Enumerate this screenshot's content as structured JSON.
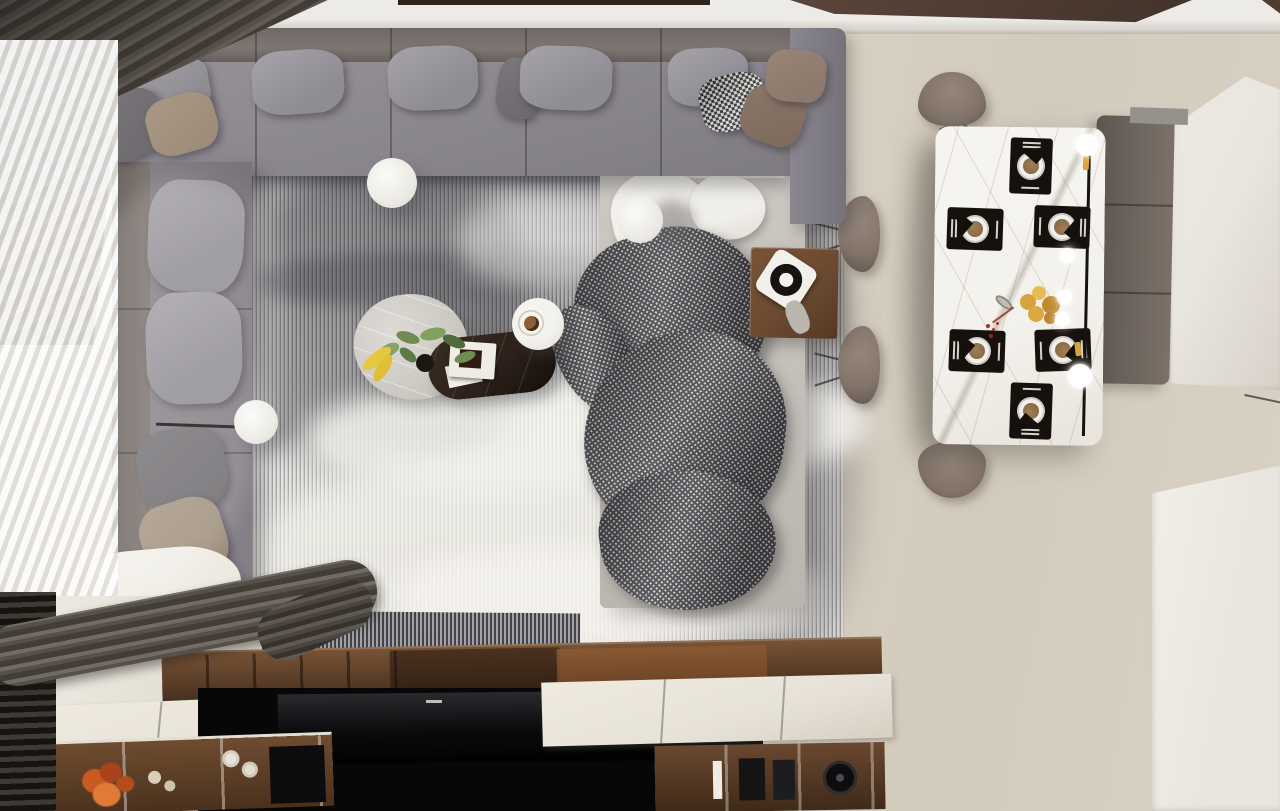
{
  "scene": {
    "title": "top-down-render-living-dining-room",
    "view": "bird's-eye interior render",
    "zones": [
      "window-side",
      "living-area",
      "dining-area",
      "media-wall"
    ]
  },
  "palette": {
    "floor": "#d8d1c2",
    "plank": "#c3baa9",
    "wall": "#edebe7",
    "ceiling": "#4e3c31",
    "bar": "#30241d",
    "drape": "#423d37",
    "sheer": "#f4f2ef",
    "blind": "#17140f",
    "sofa": "#8d8a91",
    "sofa_back": "#7b7370",
    "pillow_light": "#a6a3a9",
    "pillow_dark": "#6b686c",
    "pillow_taupe": "#9a8a77",
    "hound_dark": "#2f2e31",
    "hound_light": "#d9d8d4",
    "brown_a": "#7d6a5c",
    "brown_b": "#8a766a",
    "rug_light": "#e2e0db",
    "rug_dark": "#77767b",
    "chaise": "#c6c2bc",
    "throw": "#f0eee9",
    "cream": "#e9e5dc",
    "blanket_dark": "#45454a",
    "blanket_light": "#c9c8c3",
    "walnut": "#6b4a31",
    "walnut_dark": "#46301f",
    "marble": "#f3f1ec",
    "vein": "#aaa290",
    "dark_table": "#2c211a",
    "mat": "#17110d",
    "plate": "#f1efe9",
    "plate_in": "#8a6a45",
    "cutlery": "#d6d3cc",
    "bench": "#6e655e",
    "chair": "#83746a",
    "gold": "#d8a33d",
    "berry": "#9c3120",
    "orange": "#c45120",
    "green": "#6f8c52",
    "banana": "#e6c83e",
    "bulb": "#ffffff",
    "tv": "#070708",
    "counter": "#e7e2d8",
    "panel": "#e9e5df"
  },
  "objects": {
    "window": {
      "treatments": [
        "dark-drape",
        "sheer-curtain",
        "gathered-drape-bundle",
        "dark-blind"
      ]
    },
    "sofa": {
      "type": "u-shaped-sectional",
      "pillow_count": 15,
      "accent_pillows": [
        "houndstooth",
        "taupe",
        "dark-gray",
        "brown"
      ]
    },
    "rug": {
      "style": "fine-striped textured, sunlit patches"
    },
    "chaise": {
      "items": [
        "white-throw",
        "checked-knit-blanket"
      ]
    },
    "coffee_tables": [
      {
        "name": "organic-marble-table",
        "items": [
          "potted-plant",
          "bananas"
        ]
      },
      {
        "name": "dark-marble-oval-table",
        "items": [
          "white-tray-book",
          "dessert"
        ]
      },
      {
        "name": "round-mini-table",
        "items": [
          "coffee-cup"
        ]
      }
    ],
    "side_table": {
      "material": "walnut",
      "items": [
        "turntable",
        "gray-cloth"
      ]
    },
    "marble_disc_lamps": 3,
    "dining": {
      "table_material": "white-marble",
      "place_settings": 6,
      "chairs": 4,
      "bench_sections": 3,
      "pendant_bulbs": 5,
      "centerpiece": [
        "gold-flowers",
        "berry-sprig",
        "metal-dish"
      ]
    },
    "media_wall": {
      "tv": true,
      "shelf_items_left": [
        "dried-orange-flowers",
        "seed-spheres",
        "rolled-towels",
        "speaker"
      ],
      "shelf_items_right": [
        "book-spine",
        "black-boxes",
        "round-speaker"
      ]
    },
    "ceiling_panels": 2,
    "right_side": [
      "tall-white-cabinet",
      "white-partition"
    ]
  }
}
